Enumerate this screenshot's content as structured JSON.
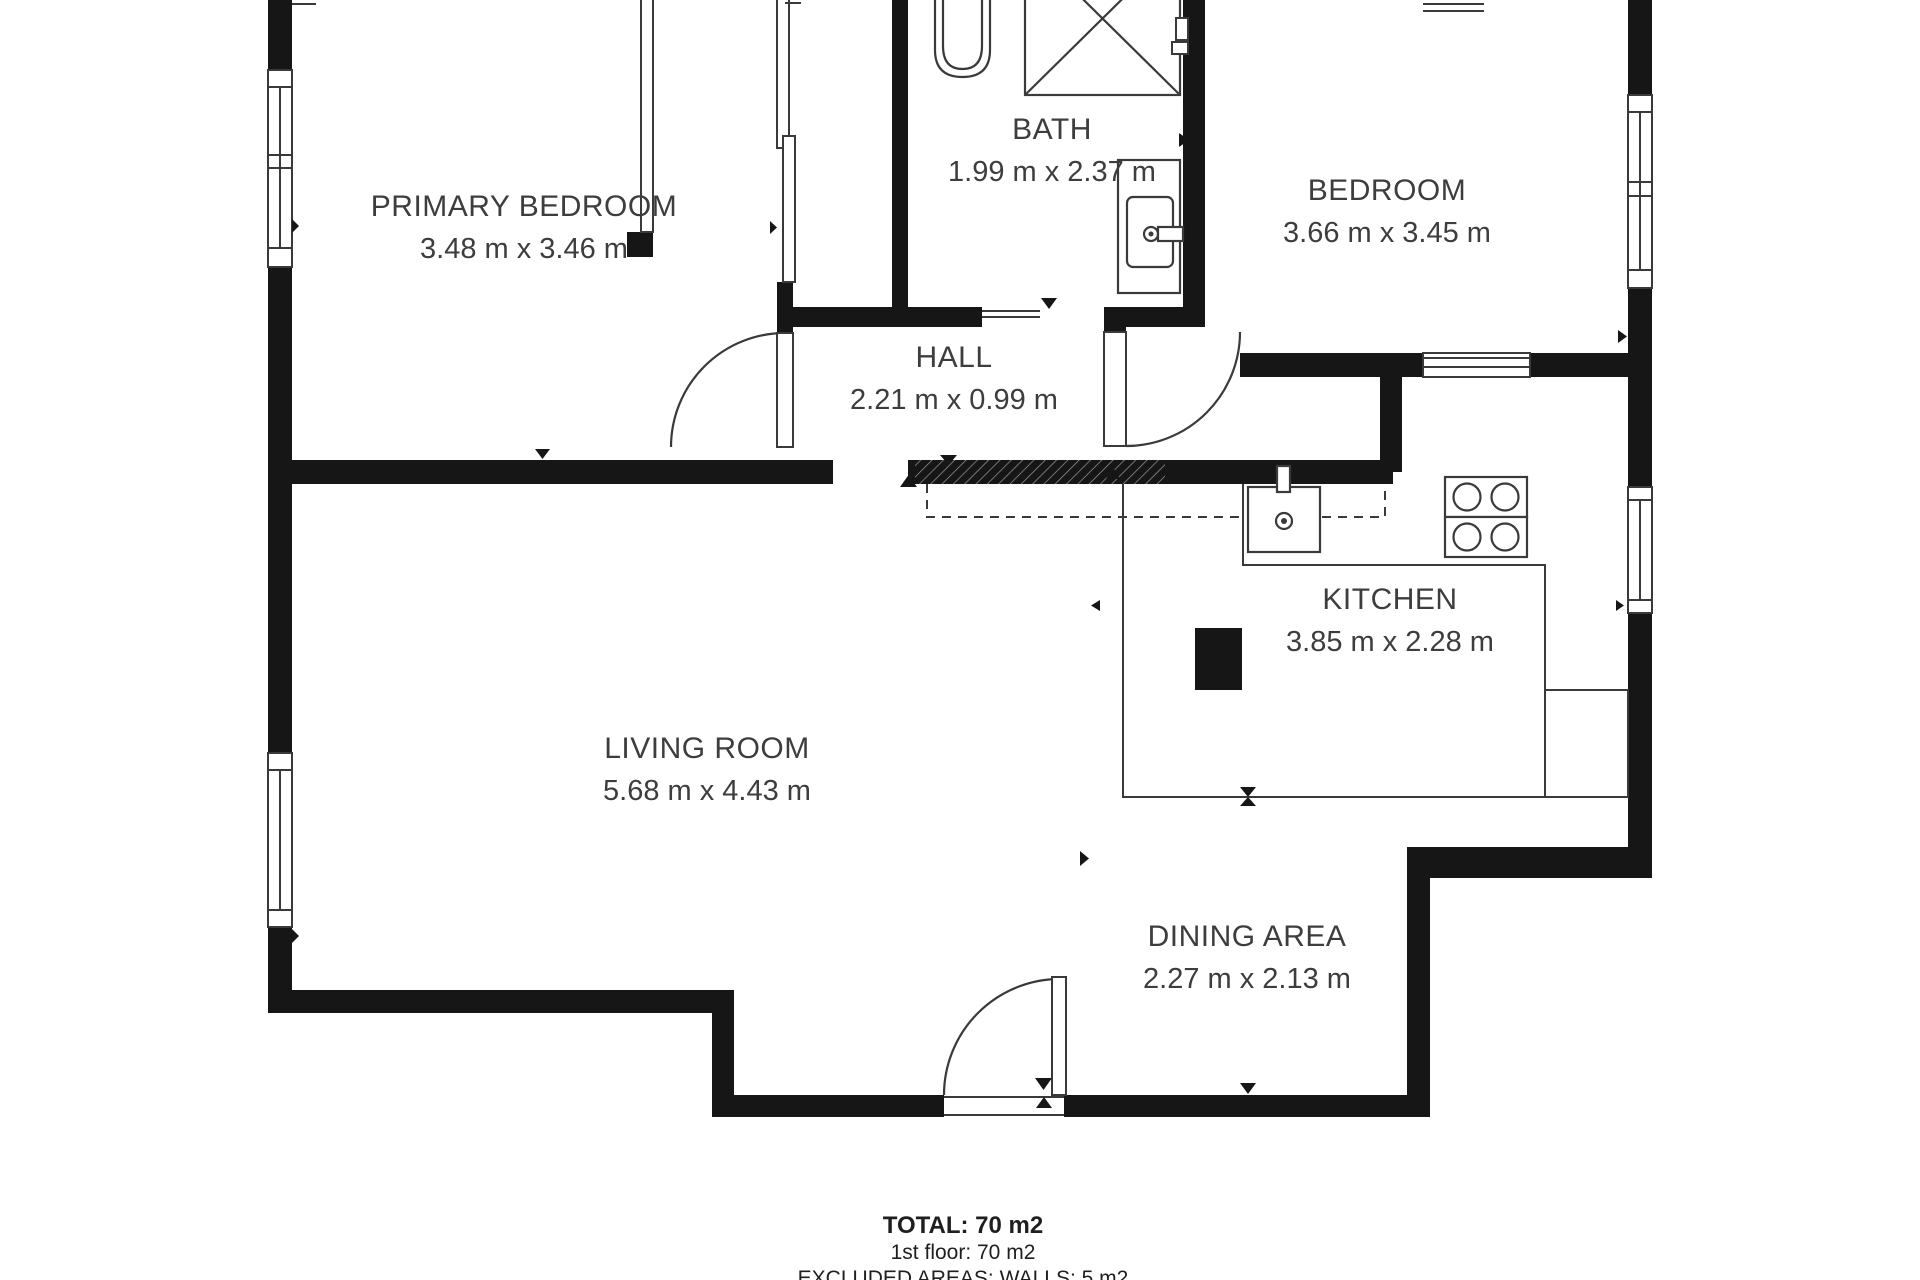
{
  "rooms": {
    "primary_bedroom": {
      "name": "PRIMARY BEDROOM",
      "dims": "3.48 m x 3.46 m"
    },
    "bath": {
      "name": "BATH",
      "dims": "1.99 m x 2.37 m"
    },
    "bedroom": {
      "name": "BEDROOM",
      "dims": "3.66 m x 3.45 m"
    },
    "hall": {
      "name": "HALL",
      "dims": "2.21 m x 0.99 m"
    },
    "kitchen": {
      "name": "KITCHEN",
      "dims": "3.85 m x 2.28 m"
    },
    "living_room": {
      "name": "LIVING ROOM",
      "dims": "5.68 m x 4.43 m"
    },
    "dining_area": {
      "name": "DINING AREA",
      "dims": "2.27 m x 2.13 m"
    }
  },
  "summary": {
    "total": "TOTAL: 70 m2",
    "floor": "1st floor: 70 m2",
    "excluded": "EXCLUDED AREAS: WALLS: 5 m2"
  },
  "colors": {
    "wall": "#161616",
    "line": "#3a3a3a",
    "text": "#3d3d3d",
    "background": "#ffffff"
  }
}
